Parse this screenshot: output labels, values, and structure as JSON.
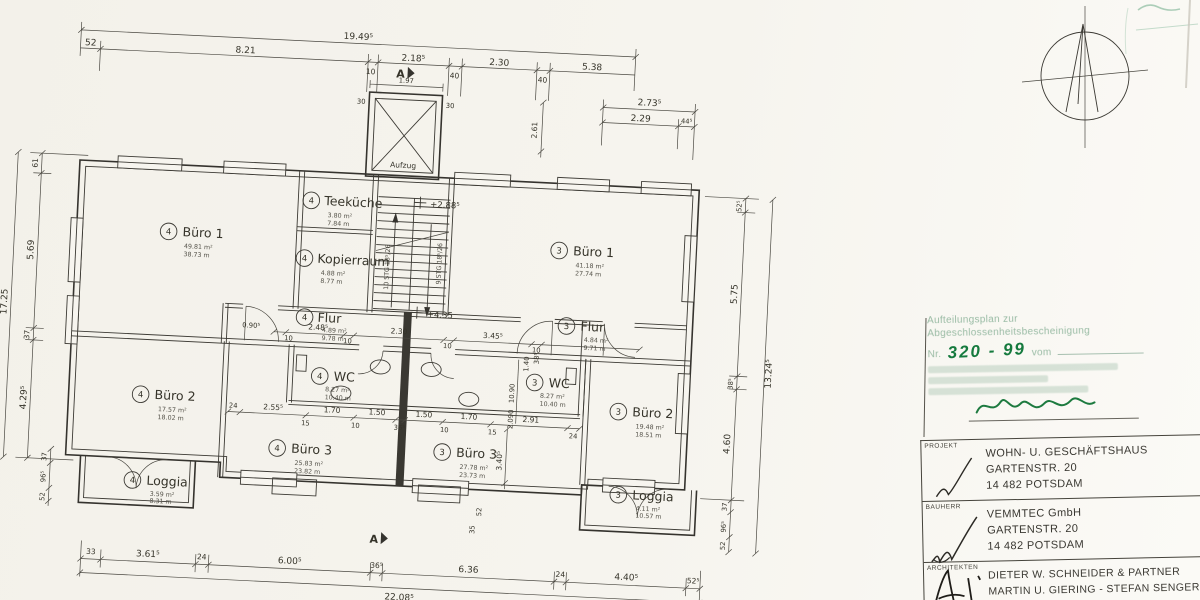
{
  "core": {
    "elevator_label": "Aufzug",
    "stair_left": "10 STG 18⁵/26",
    "stair_right": "9 STG 18⁵/26",
    "level_upper": "+2.88⁵",
    "level_lower": "+4.35",
    "section_marker": "A"
  },
  "rooms": [
    {
      "unit": "4",
      "name": "Büro 1",
      "area": "49.81 m²",
      "perim": "38.73 m"
    },
    {
      "unit": "4",
      "name": "Teeküche",
      "area": "3.80 m²",
      "perim": "7.84 m"
    },
    {
      "unit": "4",
      "name": "Kopierraum",
      "area": "4.88 m²",
      "perim": "8.77 m"
    },
    {
      "unit": "4",
      "name": "Flur",
      "area": "4.89 m²",
      "perim": "9.78 m"
    },
    {
      "unit": "4",
      "name": "WC",
      "area": "8.27 m²",
      "perim": "10.40 m"
    },
    {
      "unit": "4",
      "name": "Büro 2",
      "area": "17.57 m²",
      "perim": "18.02 m"
    },
    {
      "unit": "4",
      "name": "Büro 3",
      "area": "25.83 m²",
      "perim": "23.82 m"
    },
    {
      "unit": "4",
      "name": "Loggia",
      "area": "3.59 m²",
      "perim": "8.31 m"
    },
    {
      "unit": "3",
      "name": "Büro 1",
      "area": "41.18 m²",
      "perim": "27.74 m"
    },
    {
      "unit": "3",
      "name": "Flur",
      "area": "4.84 m²",
      "perim": "9.71 m"
    },
    {
      "unit": "3",
      "name": "WC",
      "area": "8.27 m²",
      "perim": "10.40 m"
    },
    {
      "unit": "3",
      "name": "Büro 3",
      "area": "27.78 m²",
      "perim": "23.73 m"
    },
    {
      "unit": "3",
      "name": "Büro 2",
      "area": "19.48 m²",
      "perim": "18.51 m"
    },
    {
      "unit": "3",
      "name": "Loggia",
      "area": "4.11 m²",
      "perim": "10.57 m"
    }
  ],
  "dims": {
    "top_overall": "19.49⁵",
    "top": [
      "52",
      "8.21",
      "10",
      "2.18⁵",
      "40",
      "2.30",
      "40",
      "5.38"
    ],
    "top_right": [
      "2.73⁵",
      "2.29",
      "44⁵"
    ],
    "top_right_v": "2.61",
    "elevator": [
      "1.97",
      "30",
      "30"
    ],
    "bottom": [
      "33",
      "3.61⁵",
      "24",
      "6.00⁵",
      "36⁵",
      "6.36",
      "24",
      "4.40⁵",
      "52⁵"
    ],
    "bottom_overall": "22.08⁵",
    "left": [
      "61",
      "5.69",
      "37",
      "4.29⁵"
    ],
    "left_overall": "17.25",
    "left_bottom": [
      "37",
      "96⁵",
      "52"
    ],
    "right": [
      "52⁵",
      "5.75",
      "38⁵",
      "4.60"
    ],
    "right_bottom": [
      "37",
      "96⁵",
      "52"
    ],
    "right_overall": "13.24⁵",
    "corridor": [
      "0.90⁵",
      "10",
      "2.48⁵",
      "10",
      "2.30",
      "10",
      "3.45⁵",
      "10"
    ],
    "wc": [
      "24",
      "2.55⁵",
      "15",
      "1.70",
      "10",
      "1.50",
      "36⁵",
      "1.50",
      "10",
      "1.70",
      "15",
      "2.91",
      "24"
    ],
    "inner_v": [
      "3.40⁵",
      "10.90",
      "1.40",
      "38⁵",
      "2.090",
      "52",
      "35"
    ]
  },
  "stamp": {
    "title_line1": "Aufteilungsplan zur",
    "title_line2": "Abgeschlossenheitsbescheinigung",
    "nr_label": "Nr.",
    "nr_value": "320 - 99",
    "vom_label": "vom"
  },
  "titleblock": {
    "projekt_label": "PROJEKT",
    "projekt": [
      "WOHN- U. GESCHÄFTSHAUS",
      "GARTENSTR. 20",
      "14 482 POTSDAM"
    ],
    "bauherr_label": "BAUHERR",
    "bauherr": [
      "VEMMTEC  GmbH",
      "GARTENSTR. 20",
      "14 482 POTSDAM"
    ],
    "architekten_label": "ARCHITEKTEN",
    "architekten": [
      "DIETER W. SCHNEIDER & PARTNER",
      "MARTIN U. GIERING - STEFAN SENGER"
    ]
  }
}
